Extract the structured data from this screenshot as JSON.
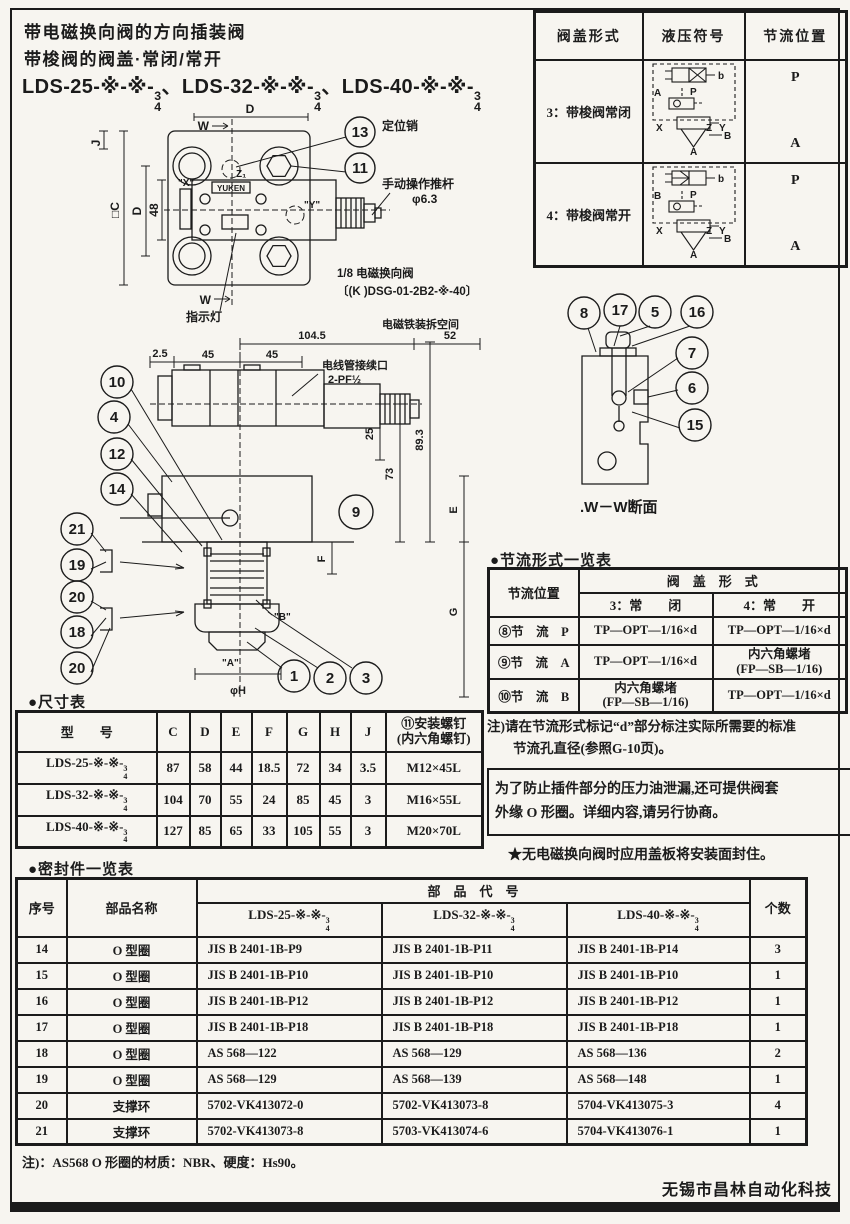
{
  "colors": {
    "paper": "#f7f5f0",
    "ink": "#1b1b1b"
  },
  "header": {
    "title_line1": "带电磁换向阀的方向插装阀",
    "title_line2": "带梭阀的阀盖·常闭/常开",
    "model_prefixes": [
      "LDS-25-※-※-",
      "、LDS-32-※-※-",
      "、LDS-40-※-※-"
    ],
    "frac_top": "3",
    "frac_bottom": "4"
  },
  "cover_table": {
    "headers": [
      "阀盖形式",
      "液压符号",
      "节流位置"
    ],
    "rows": [
      {
        "label": "3：带梭阀常闭",
        "pos_top": "P",
        "pos_bottom": "A",
        "sym": {
          "left": "A",
          "p": "P",
          "b": "b",
          "x": "X",
          "z": "Z",
          "y": "Y",
          "bport": "B",
          "aport": "A"
        }
      },
      {
        "label": "4：带梭阀常开",
        "pos_top": "P",
        "pos_bottom": "A",
        "sym": {
          "left": "B",
          "p": "P",
          "b": "b",
          "x": "X",
          "z": "Z",
          "y": "Y",
          "bport": "B",
          "aport": "A"
        }
      }
    ]
  },
  "drawings": {
    "plan": {
      "callout_top": "13",
      "callout_bottom": "11",
      "callout_13_label": "定位销",
      "dim_d": "D",
      "w": "W",
      "j": "J",
      "c": "□C",
      "d2": "D",
      "d48": "48",
      "port_x": "\"X\"",
      "port_y": "\"Y\"",
      "port_z": "Z₁",
      "brand": "YUKEN",
      "pushrod_label": "手动操作推杆",
      "pushrod_dia": "φ6.3",
      "solenoid_label": "1/8 电磁换向阀",
      "solenoid_model": "〔(K )DSG-01-2B2-※-40〕",
      "indicator_label": "指示灯"
    },
    "front": {
      "left_callouts": [
        "10",
        "4",
        "12",
        "14",
        "21",
        "19",
        "20",
        "18",
        "20"
      ],
      "bottom_callouts": [
        "1",
        "2",
        "3"
      ],
      "callout_9": "9",
      "dim_104": "104.5",
      "dim_52": "52",
      "dim_2_5": "2.5",
      "dim_45a": "45",
      "dim_45b": "45",
      "dim_73": "73",
      "dim_89": "89.3",
      "dim_25": "25",
      "dim_e": "E",
      "dim_f": "F",
      "dim_g": "G",
      "dim_h": "φH",
      "port_a": "\"A\"",
      "port_b": "\"B\"",
      "space_label": "电磁铁装拆空间",
      "conduit_label": "电线管接续口",
      "conduit_size": "2-PF½"
    },
    "ww": {
      "callouts": [
        "8",
        "17",
        "5",
        "16",
        "7",
        "6",
        "15"
      ],
      "caption": ".W－W断面"
    }
  },
  "throttle_table": {
    "heading": "●节流形式一览表",
    "col1_header": "节流位置",
    "span_header": "阀　盖　形　式",
    "sub_headers": [
      "3：常　　闭",
      "4：常　　开"
    ],
    "rows": [
      {
        "pos": "⑧节　流　P",
        "closed_l1": "TP—OPT—1/16×d",
        "closed_l2": "",
        "open_l1": "TP—OPT—1/16×d",
        "open_l2": ""
      },
      {
        "pos": "⑨节　流　A",
        "closed_l1": "TP—OPT—1/16×d",
        "closed_l2": "",
        "open_l1": "内六角螺堵",
        "open_l2": "(FP—SB—1/16)"
      },
      {
        "pos": "⑩节　流　B",
        "closed_l1": "内六角螺堵",
        "closed_l2": "(FP—SB—1/16)",
        "open_l1": "TP—OPT—1/16×d",
        "open_l2": ""
      }
    ]
  },
  "notes": {
    "note1_l1": "注)请在节流形式标记“d”部分标注实际所需要的标准",
    "note1_l2": "节流孔直径(参照G-10页)。",
    "boxed_l1": "为了防止插件部分的压力油泄漏,还可提供阀套",
    "boxed_l2": "外缘 O 形圈。详细内容,请另行协商。",
    "star_note": "★无电磁换向阀时应用盖板将安装面封住。"
  },
  "dimension_table": {
    "heading": "●尺寸表",
    "col_model": "型　　号",
    "cols": [
      "C",
      "D",
      "E",
      "F",
      "G",
      "H",
      "J"
    ],
    "screw_l1": "⑪安装螺钉",
    "screw_l2": "(内六角螺钉)",
    "rows": [
      {
        "model_prefix": "LDS-25-※-※-",
        "c": "87",
        "d": "58",
        "e": "44",
        "f": "18.5",
        "g": "72",
        "h": "34",
        "j": "3.5",
        "screw": "M12×45L"
      },
      {
        "model_prefix": "LDS-32-※-※-",
        "c": "104",
        "d": "70",
        "e": "55",
        "f": "24",
        "g": "85",
        "h": "45",
        "j": "3",
        "screw": "M16×55L"
      },
      {
        "model_prefix": "LDS-40-※-※-",
        "c": "127",
        "d": "85",
        "e": "65",
        "f": "33",
        "g": "105",
        "h": "55",
        "j": "3",
        "screw": "M20×70L"
      }
    ]
  },
  "seal_table": {
    "heading": "●密封件一览表",
    "col_no": "序号",
    "col_name": "部品名称",
    "span_header": "部　品　代　号",
    "col_qty": "个数",
    "model_prefixes": [
      "LDS-25-※-※-",
      "LDS-32-※-※-",
      "LDS-40-※-※-"
    ],
    "rows": [
      {
        "no": "14",
        "name": "O 型圈",
        "c1": "JIS B 2401-1B-P9",
        "c2": "JIS B 2401-1B-P11",
        "c3": "JIS B 2401-1B-P14",
        "qty": "3"
      },
      {
        "no": "15",
        "name": "O 型圈",
        "c1": "JIS B 2401-1B-P10",
        "c2": "JIS B 2401-1B-P10",
        "c3": "JIS B 2401-1B-P10",
        "qty": "1"
      },
      {
        "no": "16",
        "name": "O 型圈",
        "c1": "JIS B 2401-1B-P12",
        "c2": "JIS B 2401-1B-P12",
        "c3": "JIS B 2401-1B-P12",
        "qty": "1"
      },
      {
        "no": "17",
        "name": "O 型圈",
        "c1": "JIS B 2401-1B-P18",
        "c2": "JIS B 2401-1B-P18",
        "c3": "JIS B 2401-1B-P18",
        "qty": "1"
      },
      {
        "no": "18",
        "name": "O 型圈",
        "c1": "AS 568—122",
        "c2": "AS 568—129",
        "c3": "AS 568—136",
        "qty": "2"
      },
      {
        "no": "19",
        "name": "O 型圈",
        "c1": "AS 568—129",
        "c2": "AS 568—139",
        "c3": "AS 568—148",
        "qty": "1"
      },
      {
        "no": "20",
        "name": "支撑环",
        "c1": "5702-VK413072-0",
        "c2": "5702-VK413073-8",
        "c3": "5704-VK413075-3",
        "qty": "4"
      },
      {
        "no": "21",
        "name": "支撑环",
        "c1": "5702-VK413073-8",
        "c2": "5703-VK413074-6",
        "c3": "5704-VK413076-1",
        "qty": "1"
      }
    ],
    "footnote": "注)：AS568 O 形圈的材质：NBR、硬度：Hs90。"
  },
  "footer": {
    "company": "无锡市昌林自动化科技"
  }
}
